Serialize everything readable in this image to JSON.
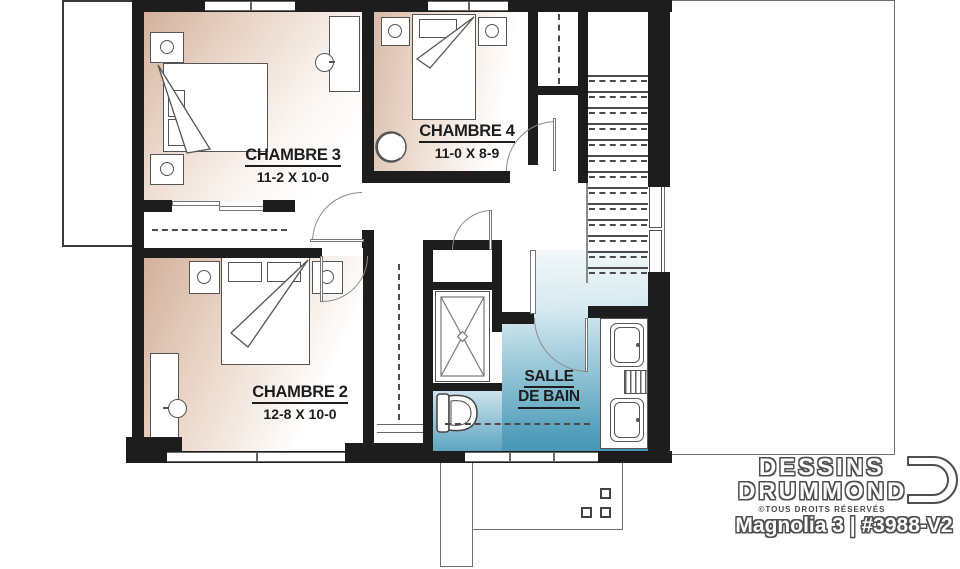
{
  "plan": {
    "rooms": [
      {
        "name": "CHAMBRE 3",
        "dims": "11-2 X 10-0"
      },
      {
        "name": "CHAMBRE 4",
        "dims": "11-0 X 8-9"
      },
      {
        "name": "CHAMBRE 2",
        "dims": "12-8 X 10-0"
      },
      {
        "name": "SALLE DE BAIN",
        "name_line1": "SALLE",
        "name_line2": "DE BAIN"
      }
    ],
    "stairs": {
      "tread_count": 13
    },
    "fixtures": [
      "bed",
      "nightstand",
      "lamp",
      "desk",
      "chair",
      "closet-rod",
      "sliding-closet-doors",
      "shower",
      "toilet",
      "double-sink-vanity",
      "staircase",
      "deck-posts",
      "door-swing"
    ]
  },
  "branding": {
    "company_word1": "DESSINS",
    "company_word2": "DRUMMOND",
    "rights_notice": "©TOUS DROITS RÉSERVÉS",
    "plan_title": "Magnolia 3 | #3988-V2"
  },
  "colors": {
    "wall": "#1d1d1d",
    "bedroom_tint": "#d2b09b",
    "bathroom_blue": "#4894b4",
    "drawing_line": "#555555"
  }
}
